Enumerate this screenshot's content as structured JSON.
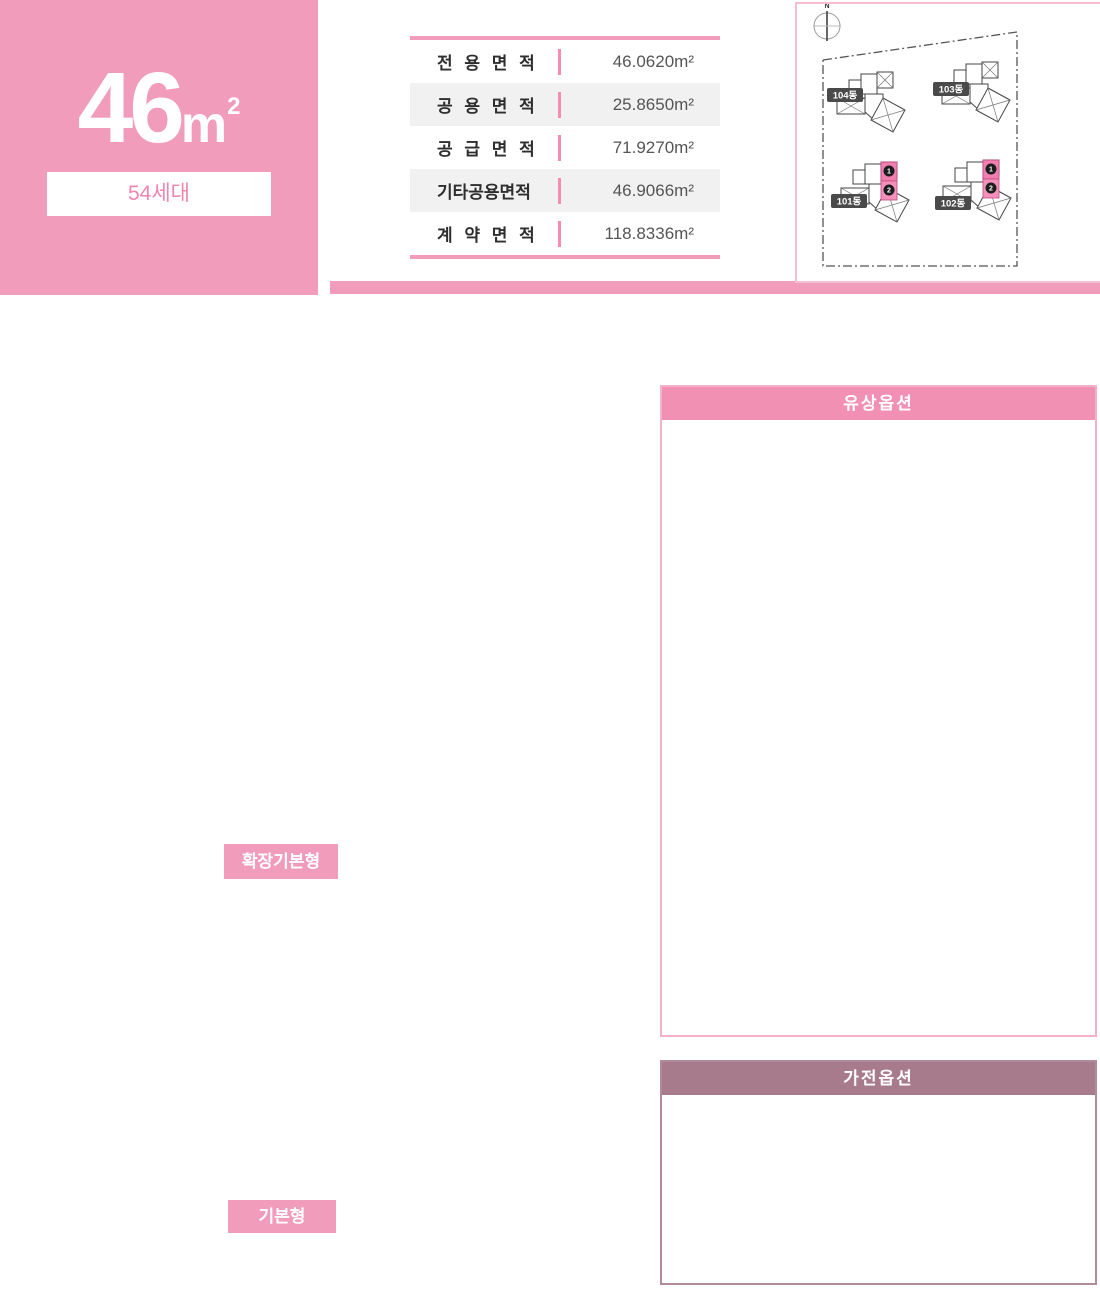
{
  "unit": {
    "size_number": "46",
    "size_unit": "m",
    "size_sup": "2",
    "households": "54세대"
  },
  "area_table": {
    "rows": [
      {
        "label": "전 용 면 적",
        "value": "46.0620m²"
      },
      {
        "label": "공 용 면 적",
        "value": "25.8650m²"
      },
      {
        "label": "공 급 면 적",
        "value": "71.9270m²"
      },
      {
        "label": "기타공용면적",
        "value": "46.9066m²"
      },
      {
        "label": "계 약 면 적",
        "value": "118.8336m²"
      }
    ]
  },
  "site_plan": {
    "compass_label": "N",
    "buildings": [
      {
        "name": "104동",
        "highlighted": false
      },
      {
        "name": "103동",
        "highlighted": false
      },
      {
        "name": "101동",
        "highlighted": true,
        "unit_markers": [
          "1",
          "2"
        ]
      },
      {
        "name": "102동",
        "highlighted": true,
        "unit_markers": [
          "1",
          "2"
        ]
      }
    ]
  },
  "floor_plans": [
    {
      "label": "확장기본형"
    },
    {
      "label": "기본형"
    }
  ],
  "floorplan": {
    "rooms": [
      {
        "id": "balcony2",
        "label": "발코니2"
      },
      {
        "id": "kitchen",
        "label": "주방"
      },
      {
        "id": "entry",
        "label": "현관"
      },
      {
        "id": "bath",
        "label": "욕실"
      },
      {
        "id": "dress",
        "label": "드레스룸"
      },
      {
        "id": "pantry",
        "label": "팬트리"
      },
      {
        "id": "bed1",
        "label": "침실1"
      },
      {
        "id": "living",
        "label": "거실"
      },
      {
        "id": "bed2",
        "label": "침실2"
      },
      {
        "id": "outdoor",
        "label": "실외기실"
      },
      {
        "id": "balcony1",
        "label": "발코니1"
      }
    ],
    "markers": [
      {
        "num": "1",
        "color": "#8cb267"
      },
      {
        "num": "2",
        "color": "#1a6cb4"
      },
      {
        "num": "3",
        "color": "#f06380"
      },
      {
        "num": "4",
        "color": "#f6a623"
      },
      {
        "num": "5",
        "color": "#57b0a6"
      },
      {
        "num": "6",
        "color": "#5e8fa6"
      },
      {
        "num": "7",
        "color": "#94846a"
      },
      {
        "num": "8",
        "color": "#9a8cc6"
      },
      {
        "num": "9",
        "color": "#8fa989"
      }
    ]
  },
  "paid_options": {
    "title": "유상옵션",
    "items": [
      {
        "num": "1",
        "color": "#8cb267",
        "title": "현관 3연동 중문",
        "lines": [
          "① 실속형 : 일반형",
          "② 프리미엄형 : 자동형"
        ]
      },
      {
        "num": "2",
        "color": "#1a6cb4",
        "title": "침실2",
        "lines": [
          "① 붙박이장"
        ]
      },
      {
        "num": "3",
        "color": "#f06380",
        "title": "거실 우물천장 + 조명",
        "lines": [
          "① 실속형 : 우물천장",
          "② 프리미엄형 : 우물천장 +",
          "조명 특화(거실/주방)"
        ]
      },
      {
        "num": "4",
        "color": "#f6a623",
        "title": "거실 특화",
        "lines": [
          "① 실속형 : 아트월 타일(침실1-거실 벽면)",
          "② 프리미엄형 : 히든도어 + 보드판넬"
        ]
      },
      {
        "num": "5",
        "color": "#57b0a6",
        "title": "욕실 특화",
        "lines": []
      },
      {
        "num": "6",
        "color": "#5e8fa6",
        "title": "아일랜드 식탁",
        "lines": [
          "① 조명 + 매립형 콘센트 포함, MMA"
        ]
      },
      {
        "num": "7",
        "color": "#94846a",
        "title": "주방 특화",
        "lines": [
          "① 실속형 : 냉장고장",
          "② 프리미엄형1 : 엔지니어드 스톤(벽체/상판), 냉장고장, 고급 니켈 수전,",
          "아일랜드 식탁(엔지니어드 스톤 상판, 조명 + 매립형 콘센트 포함)",
          "③ 프리미엄형2 : 프리미엄형1 + 비스포크 냉장고 3도어"
        ]
      },
      {
        "num": "8",
        "color": "#9a8cc6",
        "title": "주방 팬트리",
        "lines": [
          "① 가구 도어 + 폴대형 시스템가구 + 픽스판넬"
        ]
      },
      {
        "num": "9",
        "color": "#8fa989",
        "title": "침실1/주방 수납 특화",
        "lines": [
          "① 실속형 : 주방 팬트리 + 드레스룸",
          "② 프리미엄형 : 주방 팬트리 +",
          "                  고급 드레스룸"
        ]
      },
      {
        "num": "10",
        "color": "#8e2232",
        "title": "바닥",
        "lines": [
          "① 프리미엄 광폭 강마루"
        ]
      }
    ]
  },
  "appliance_options": {
    "title": "가전옵션",
    "sections": [
      {
        "title": "주방",
        "lines": [
          "① 비스포크 냉장고 3도어",
          "② 전기오븐(블랙)",
          "③ 비스포크 전기오븐(화이트)",
          "④ 비스포크 3구 인덕션(화이트)",
          "⑤ 식기세척기"
        ]
      },
      {
        "title": "시스템에어컨",
        "lines": [
          "① 거실, 침실1(2대)",
          "② 거실, 침실1, 침실2(3대)"
        ]
      }
    ]
  },
  "colors": {
    "brand_pink": "#f19cbb",
    "panel_header_pink": "#f190b2",
    "appliance_header": "#a87b8c",
    "wall": "#1a1a1a",
    "floor": "#eae3dd"
  }
}
